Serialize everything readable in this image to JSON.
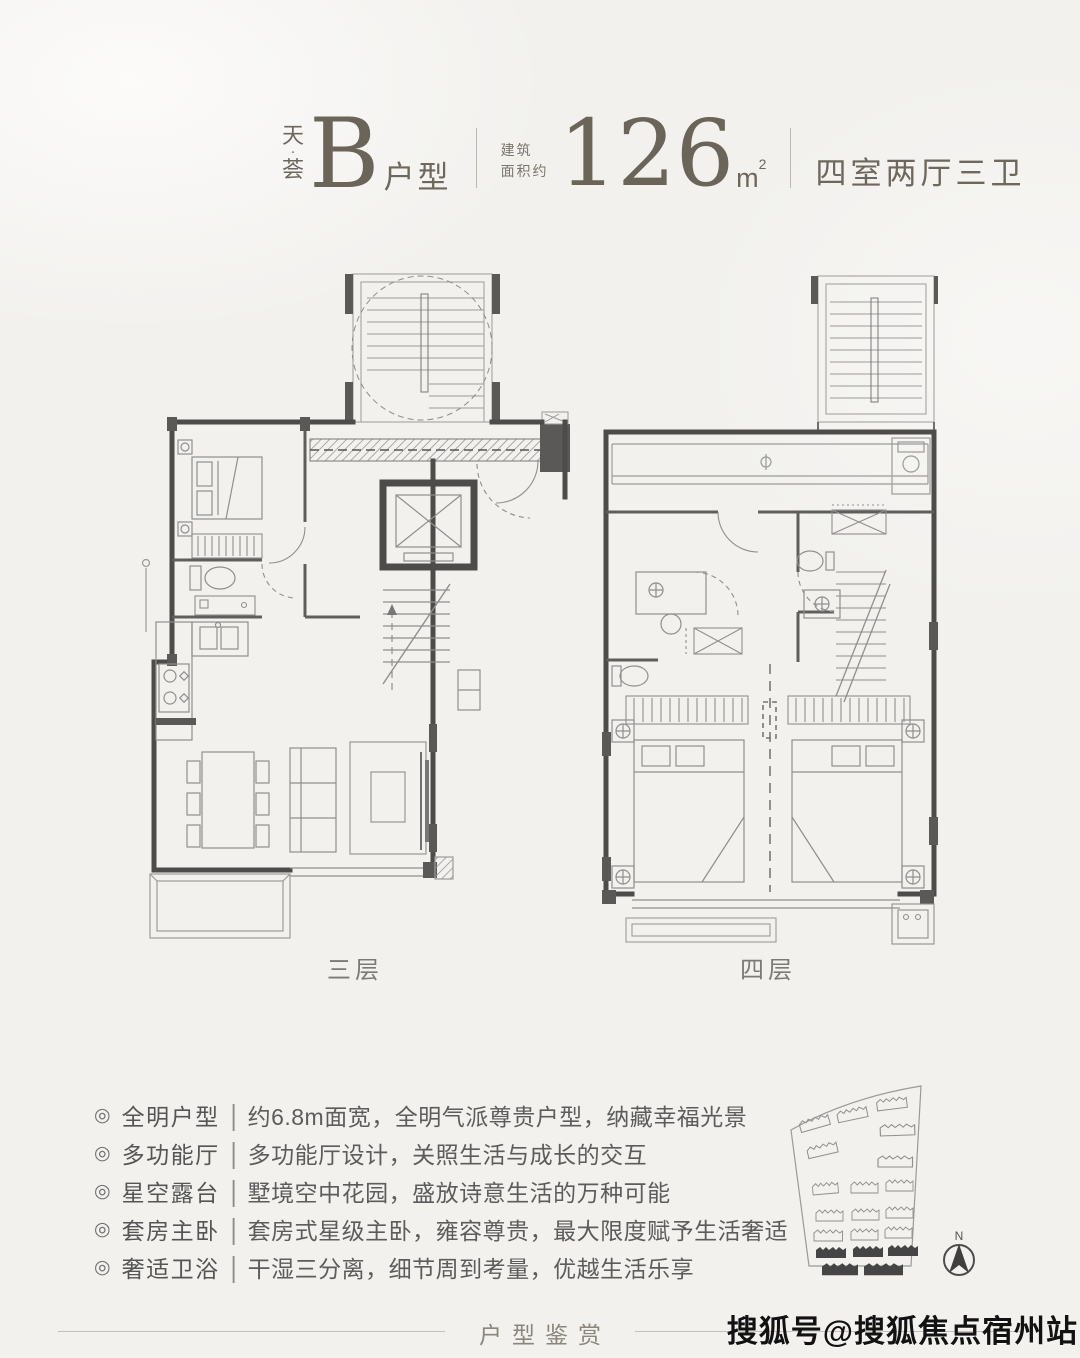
{
  "header": {
    "brand_top": "天",
    "brand_dot": "·",
    "brand_bottom": "荟",
    "unit_letter": "B",
    "unit_label": "户型",
    "area_caption_line1": "建筑",
    "area_caption_line2": "面积约",
    "area_value": "126",
    "area_unit": "m",
    "area_unit_sup": "2",
    "layout_desc": "四室两厅三卫"
  },
  "plans": [
    {
      "label": "三层"
    },
    {
      "label": "四层"
    }
  ],
  "ui": {
    "bullet": "◎",
    "separator": "|",
    "compass_label": "N"
  },
  "features": [
    {
      "tag": "全明户型",
      "desc": "约6.8m面宽，全明气派尊贵户型，纳藏幸福光景"
    },
    {
      "tag": "多功能厅",
      "desc": "多功能厅设计，关照生活与成长的交互"
    },
    {
      "tag": "星空露台",
      "desc": "墅境空中花园，盛放诗意生活的万种可能"
    },
    {
      "tag": "套房主卧",
      "desc": "套房式星级主卧，雍容尊贵，最大限度赋予生活奢适"
    },
    {
      "tag": "奢适卫浴",
      "desc": "干湿三分离，细节周到考量，优越生活乐享"
    }
  ],
  "footer": {
    "title": "户型鉴赏",
    "subtitle": "MARINE CITY",
    "watermark": "搜狐号@搜狐焦点宿州站"
  },
  "colors": {
    "background": "#f2f1ee",
    "wall": "#4d4c4a",
    "thin_line": "#9b9b9b",
    "header_text": "#6b6459",
    "body_text": "#5c5c5c",
    "site_building_fill": "#454545"
  }
}
